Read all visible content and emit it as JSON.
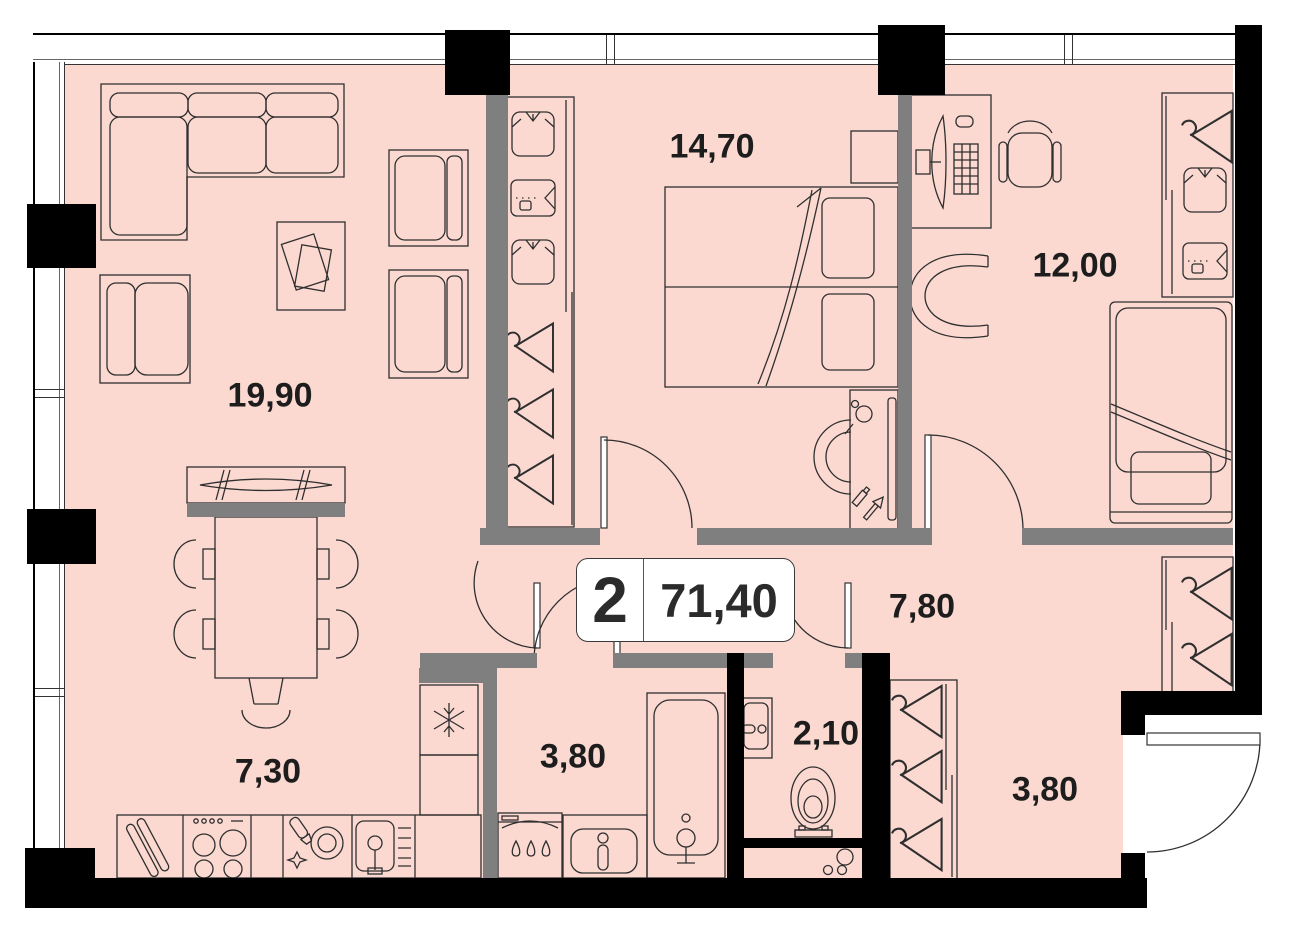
{
  "plan": {
    "unit": {
      "rooms_count": "2",
      "total_area": "71,40"
    },
    "rooms": [
      {
        "name": "living-room",
        "area": "19,90"
      },
      {
        "name": "bedroom",
        "area": "14,70"
      },
      {
        "name": "office",
        "area": "12,00"
      },
      {
        "name": "hallway",
        "area": "7,80"
      },
      {
        "name": "kitchen",
        "area": "7,30"
      },
      {
        "name": "bathroom",
        "area": "3,80"
      },
      {
        "name": "wc",
        "area": "2,10"
      },
      {
        "name": "entry-hall",
        "area": "3,80"
      }
    ],
    "colors": {
      "floor": "#fbd9d1",
      "interior_wall": "#7f7f7f",
      "exterior_wall": "#000000",
      "furniture_line": "#2f2f2f",
      "card_border": "#3a3a3a"
    }
  }
}
